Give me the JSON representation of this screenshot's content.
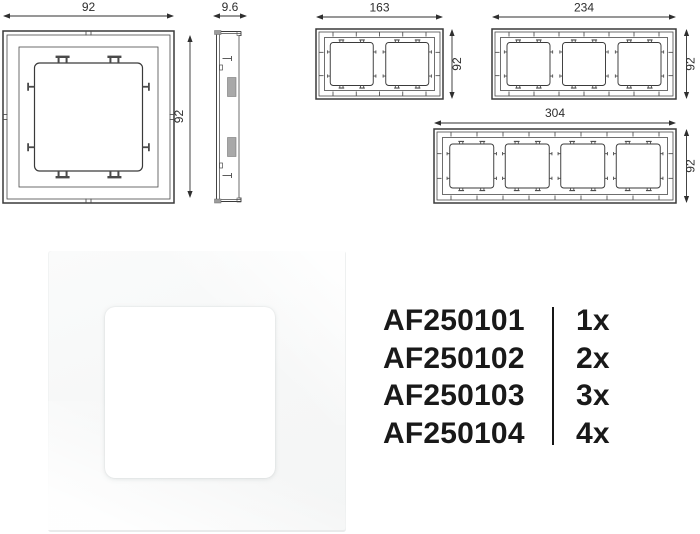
{
  "page": {
    "kind": "product datasheet sheet",
    "background": "#ffffff"
  },
  "drawings": {
    "front_1gang": {
      "name": "1-gang frame front view",
      "gangs": 1,
      "width_label": "92",
      "height_label": "92"
    },
    "side_profile": {
      "name": "frame side profile view",
      "depth_label": "9.6"
    },
    "front_2gang": {
      "name": "2-gang frame front view",
      "gangs": 2,
      "width_label": "163",
      "height_label": "92"
    },
    "front_3gang": {
      "name": "3-gang frame front view",
      "gangs": 3,
      "width_label": "234",
      "height_label": "92"
    },
    "front_4gang": {
      "name": "4-gang frame front view",
      "gangs": 4,
      "width_label": "304",
      "height_label": "92"
    }
  },
  "photo": {
    "description": "white 1-gang cover frame product photo"
  },
  "order_table": {
    "rows": [
      {
        "code": "AF250101",
        "qty": "1x"
      },
      {
        "code": "AF250102",
        "qty": "2x"
      },
      {
        "code": "AF250103",
        "qty": "3x"
      },
      {
        "code": "AF250104",
        "qty": "4x"
      }
    ]
  },
  "colors": {
    "line": "#3a3a3a",
    "thin_line": "#4a4a4a",
    "dim_line": "#2f2f2f",
    "dim_text": "#2d2d2d",
    "table_text": "#191919",
    "photo_frame": "#f6f7f7",
    "photo_opening": "#ffffff",
    "clip_fill": "#a8a8a8"
  }
}
